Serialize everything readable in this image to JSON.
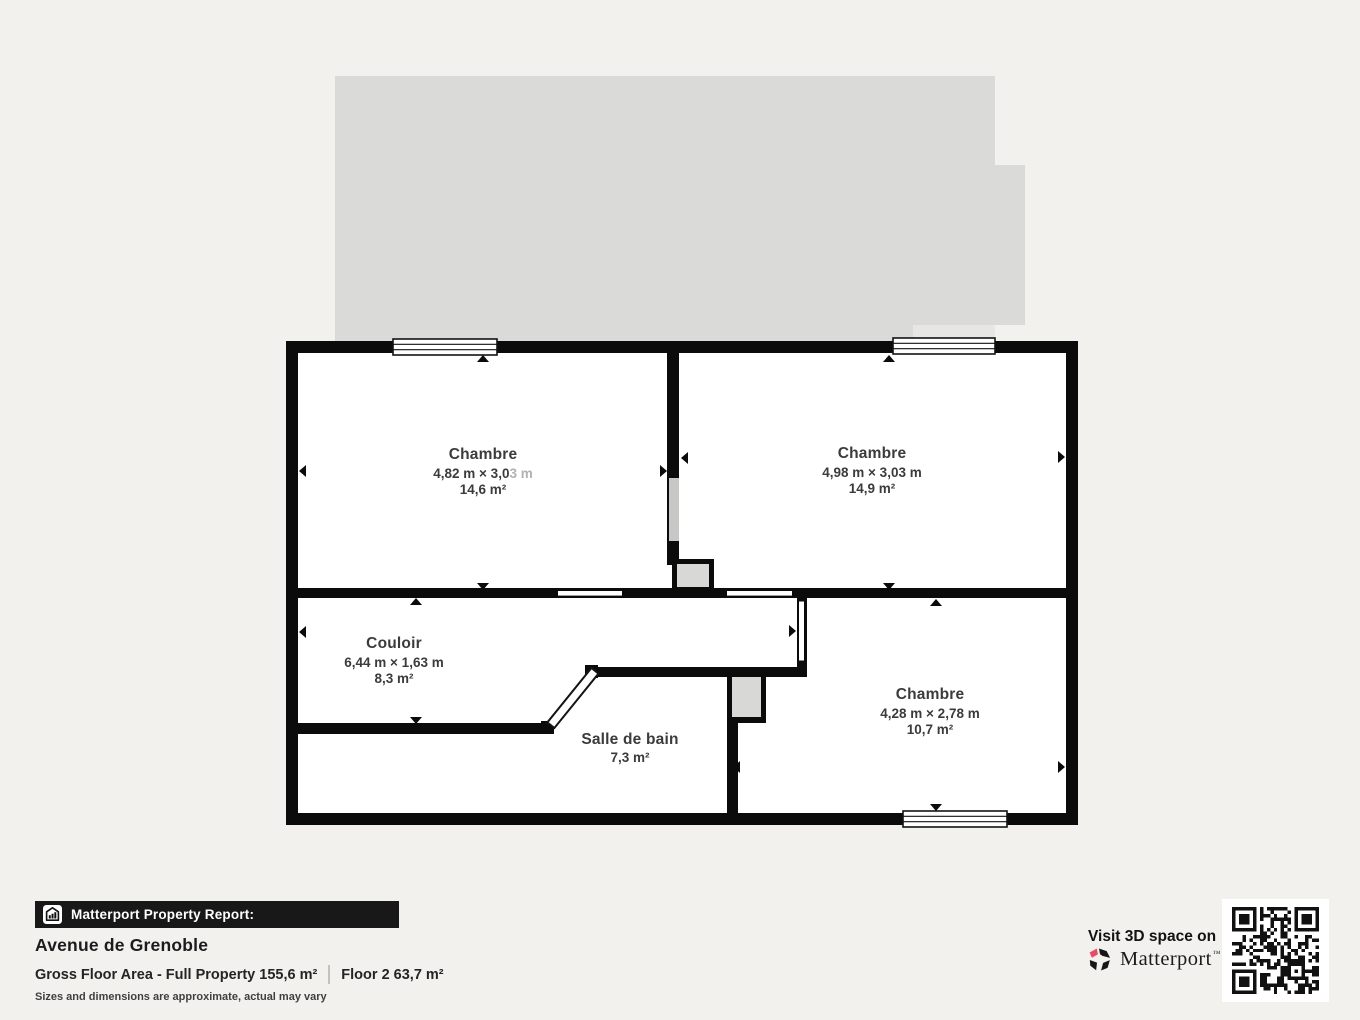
{
  "plan": {
    "rooms": [
      {
        "name": "Chambre",
        "dims": "4,82 m × 3,0",
        "dims_faded": "3 m",
        "area": "14,6 m²"
      },
      {
        "name": "Chambre",
        "dims": "4,98 m × 3,03 m",
        "area": "14,9 m²"
      },
      {
        "name": "Couloir",
        "dims": "6,44 m × 1,63 m",
        "area": "8,3 m²"
      },
      {
        "name": "Salle de bain",
        "area": "7,3 m²"
      },
      {
        "name": "Chambre",
        "dims": "4,28 m × 2,78 m",
        "area": "10,7 m²"
      }
    ]
  },
  "report": {
    "bar_label": "Matterport Property Report:",
    "address": "Avenue de Grenoble",
    "gross_floor_area": "Gross Floor Area - Full Property 155,6 m²",
    "floor_area": "Floor 2 63,7 m²",
    "disclaimer": "Sizes and dimensions are approximate, actual may vary"
  },
  "promo": {
    "visit_label": "Visit 3D space on",
    "brand": "Matterport",
    "brand_mark": "™"
  },
  "colors": {
    "background": "#f2f1ee",
    "wall_black": "#0b0b0b",
    "upper_floor_gray": "#dadad9",
    "duct_gray": "#d8d8d7",
    "brand_pink": "#ea4a68",
    "label_text": "#3b3b3b"
  }
}
